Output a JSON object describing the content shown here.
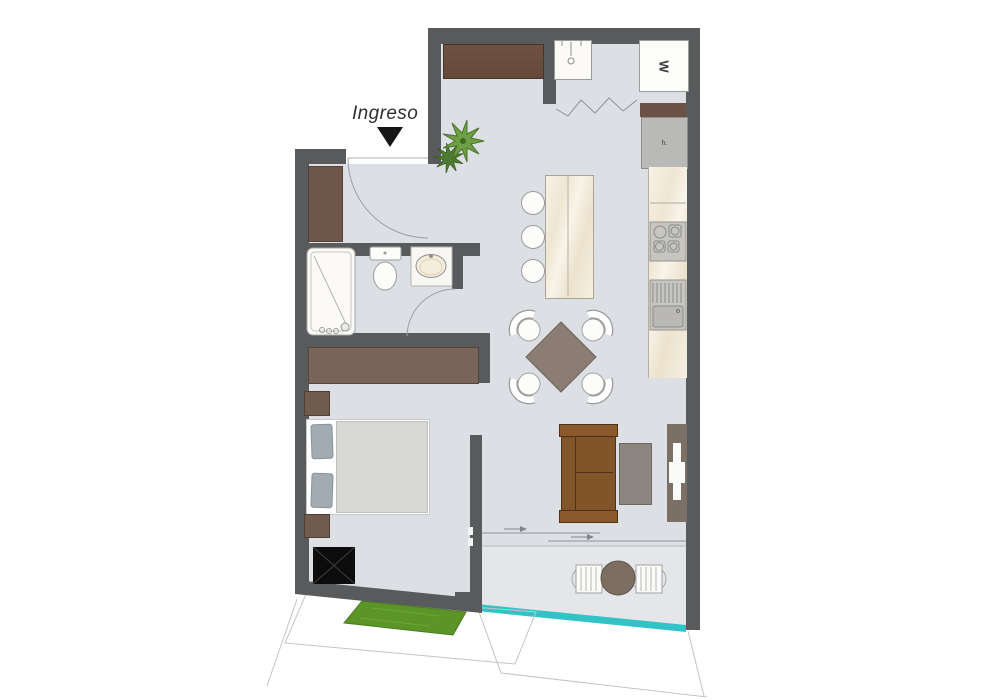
{
  "labels": {
    "entrance": "Ingreso",
    "washer": "W",
    "fridge": "h."
  },
  "icons": {
    "entrance_arrow": "triangle-down-icon",
    "shaft": "crossed-box-icon",
    "plant": "plant-icon"
  },
  "colors": {
    "wall": "#595a5c",
    "wood_dark": "#6a4c3f",
    "wood_mid": "#786459",
    "floor": "#dcdfe3",
    "balcony_floor": "#e3e5e8",
    "railing_teal": "#33c3c6",
    "grass_green": "#5b9427",
    "sofa_brown": "#82542a",
    "counter_marble": "#f6f1e4",
    "dining_table": "#8b7d73",
    "plant_green": "#6f9f45"
  }
}
